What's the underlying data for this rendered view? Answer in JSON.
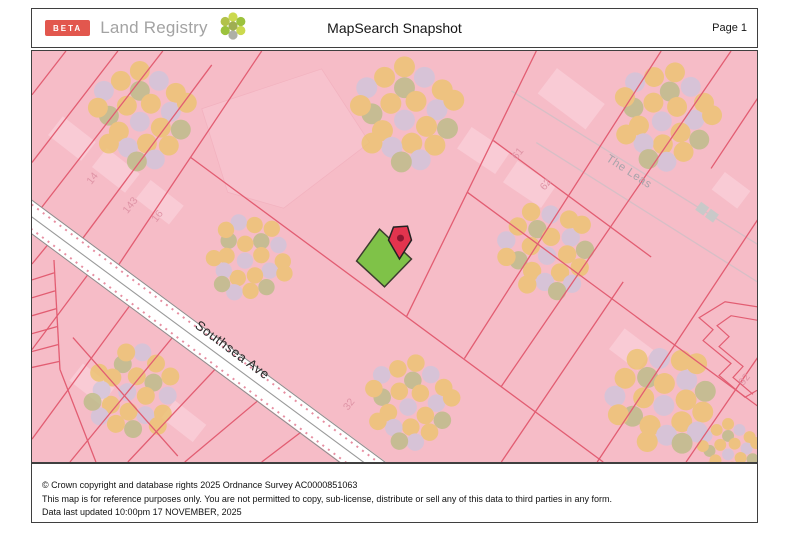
{
  "header": {
    "beta_label": "BETA",
    "brand": "Land Registry",
    "title": "MapSearch Snapshot",
    "page_label": "Page 1"
  },
  "map": {
    "background_color": "#f6bcc7",
    "boundary_color": "#e25d72",
    "road_labels": {
      "southsea": "Southsea Ave",
      "the_leas": "The Leas"
    },
    "plot_numbers": {
      "n14": "14",
      "n143": "143",
      "n16": "16",
      "n61": "61",
      "n62": "62",
      "n32": "32",
      "n92": "92"
    },
    "selected_plot": {
      "fill": "#7fc248",
      "marker_color": "#e3344e"
    }
  },
  "footer": {
    "line1": "© Crown copyright and database rights 2025 Ordnance Survey AC0000851063",
    "line2": "This map is for reference purposes only. You are not permitted to copy, sub-license, distribute or sell any of this data to third parties in any form.",
    "line3": "Data last updated 10:00pm 17 NOVEMBER, 2025"
  }
}
